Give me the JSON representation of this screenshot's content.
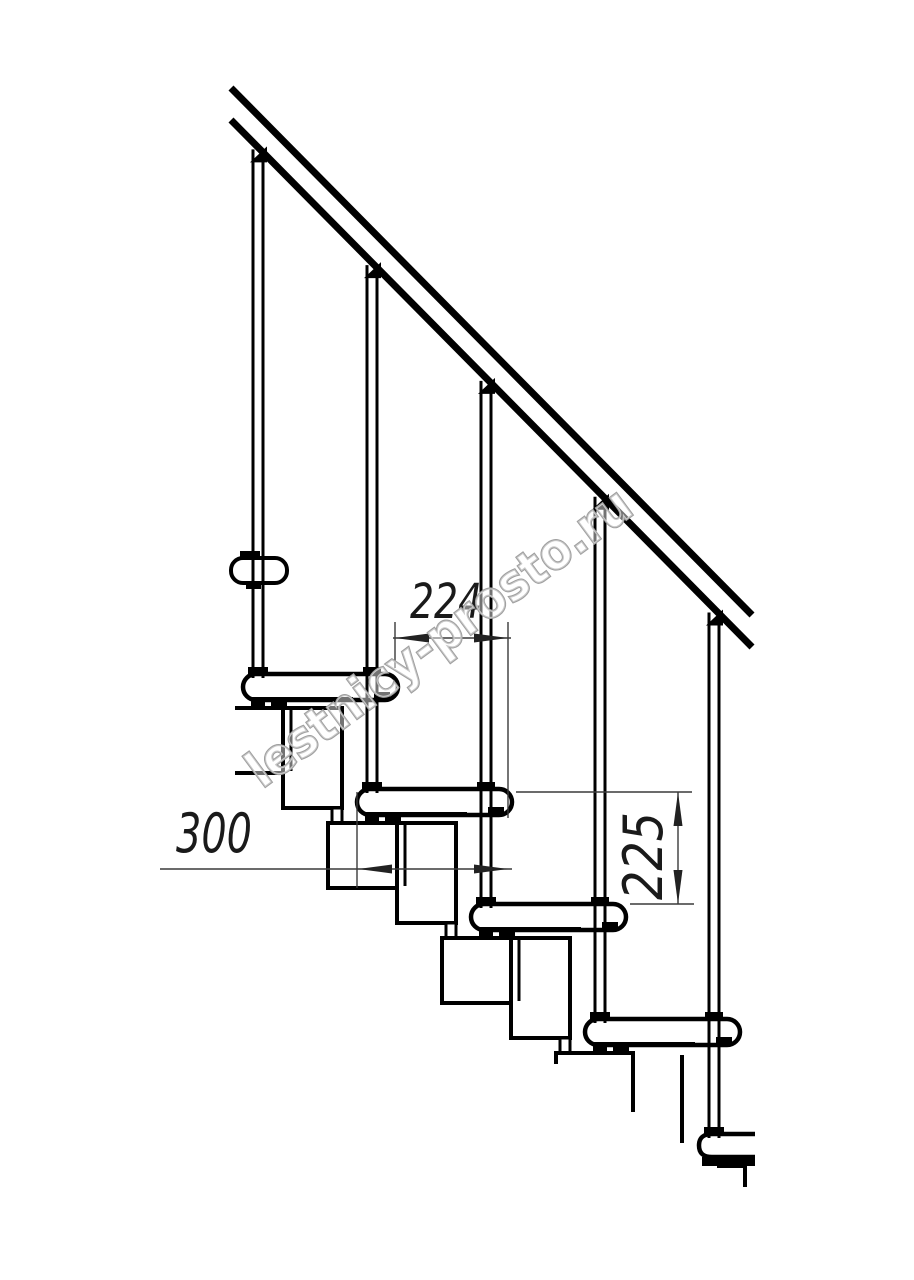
{
  "drawing": {
    "subject": "modular staircase side elevation",
    "watermark": "lestnicy-prosto.ru",
    "dimensions": [
      {
        "id": "step-run",
        "label": "224",
        "orientation": "horizontal"
      },
      {
        "id": "tread-depth",
        "label": "300",
        "orientation": "horizontal"
      },
      {
        "id": "step-rise",
        "label": "225",
        "orientation": "vertical"
      }
    ],
    "counts": {
      "balusters": 5,
      "treads_visible": 6
    },
    "colors": {
      "ink": "#000000",
      "paper": "#ffffff",
      "dimension": "#3a3a3a",
      "watermark_stroke": "#9f9f9f"
    }
  }
}
